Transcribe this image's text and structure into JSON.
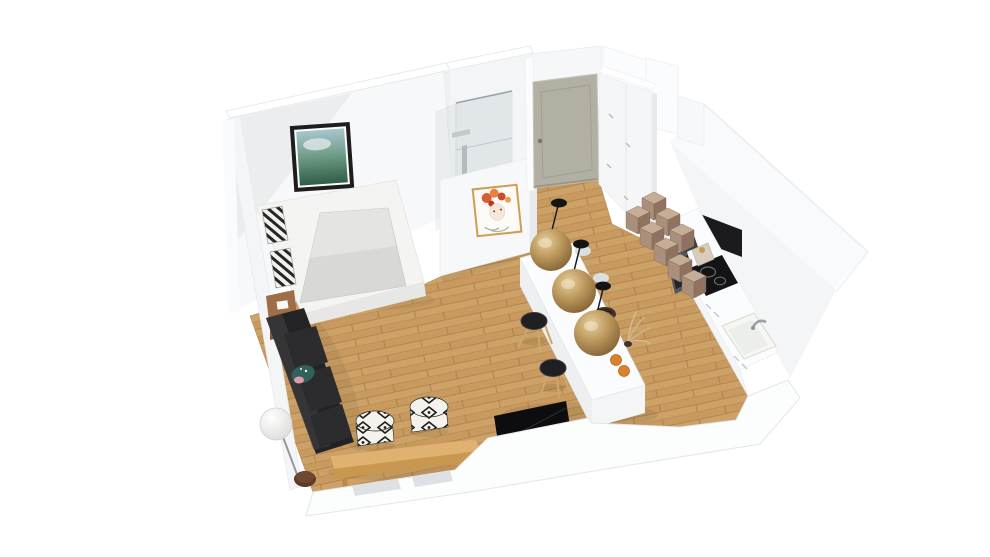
{
  "meta": {
    "description": "3D isometric cutaway rendering of a studio apartment floor plan",
    "view": "axonometric bird's-eye, white cut walls, oak floor",
    "background": "#ffffff"
  },
  "rooms": [
    {
      "name": "bedroom",
      "position": "top-left",
      "items": [
        "double-bed",
        "striped-pillows",
        "landscape-wall-art",
        "wood-nightstand"
      ]
    },
    {
      "name": "bathroom",
      "position": "top-center",
      "items": [
        "glass-shower",
        "shower-column",
        "flower-woman-wall-art"
      ]
    },
    {
      "name": "entry",
      "position": "top-center-right",
      "items": [
        "entry-door",
        "wardrobe",
        "storage-cubes"
      ]
    },
    {
      "name": "kitchen",
      "position": "right",
      "items": [
        "counter",
        "induction-hob",
        "oven",
        "sink",
        "coffee-machine",
        "toaster",
        "black-niche"
      ]
    },
    {
      "name": "living-dining",
      "position": "center",
      "items": [
        "island",
        "pendant-lamps",
        "bar-stools",
        "sofa",
        "sphere-floor-lamp",
        "round-side-table",
        "wood-bench",
        "kilim-poufs",
        "tv"
      ]
    }
  ],
  "counts": {
    "pendant_lamps": 3,
    "bar_stools": 2,
    "kilim_poufs": 2,
    "storage_cubes": 8,
    "bed_pillows": 2
  },
  "palette": {
    "background": "#ffffff",
    "wall": "#f7f8f9",
    "wall_top": "#ffffff",
    "wall_side": "#f3f5f6",
    "wall_shade": "#e8ebee",
    "floor_base": "#c89a5f",
    "door": "#b2b0a2",
    "door_panel": "#a29f91",
    "wardrobe": "#f5f6f8",
    "cube_top": "#c6ad96",
    "cube_left": "#a98f7c",
    "cube_right": "#8f7260",
    "counter_front": "#f4f5f6",
    "counter_top": "#fbfcfd",
    "niche": "#1b1b1d",
    "hob": "#141416",
    "oven": "#53575a",
    "oven_glass": "#222427",
    "sink": "#f6f6f2",
    "island_top": "#fbfcfd",
    "island_left": "#edeff1",
    "island_end": "#f4f5f6",
    "bowl": "#42332c",
    "fruit": "#d9822e",
    "stool_seat": "#202022",
    "stool_leg": "#c9a96b",
    "sofa": "#232325",
    "sofa_cushion": "#2c2c2e",
    "sofa_edge": "#3a3a3d",
    "teal_cushion": "#30615a",
    "pink_accent": "#e09aae",
    "bench_top": "#dfb271",
    "bench_front": "#c89750",
    "bench_leg": "#b9894a",
    "side_table": "#5d3b27",
    "tv": "#0d0d0f",
    "tv_block_side": "#ccd1d4",
    "mattress": "#d8d9d5",
    "bed_frame": "#f4f5f3",
    "bed_front": "#e7e8e5",
    "nightstand": "#a06e46",
    "nightstand_front": "#85572f",
    "frame_black": "#1d1d1f",
    "art_frame_gold": "#cf9c55",
    "flower_red": "#d85f35",
    "flower_orange": "#e8823f",
    "flower_dark": "#c44d2e",
    "bottom_wall": "#fcfdfd",
    "window_recess": "#dde1e4",
    "bathroom_floor": "#d8dbdd",
    "metal": "#9aa0a4"
  }
}
